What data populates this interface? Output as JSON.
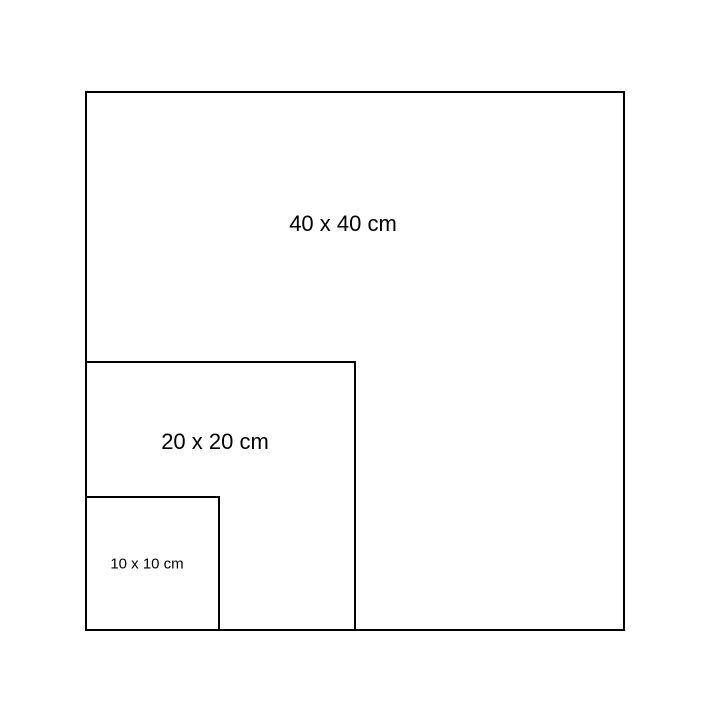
{
  "diagram": {
    "background_color": "#ffffff",
    "stroke_color": "#000000",
    "squares": [
      {
        "label": "40 x 40 cm",
        "side_cm": 40
      },
      {
        "label": "20 x 20 cm",
        "side_cm": 20
      },
      {
        "label": "10 x 10 cm",
        "side_cm": 10
      }
    ]
  }
}
